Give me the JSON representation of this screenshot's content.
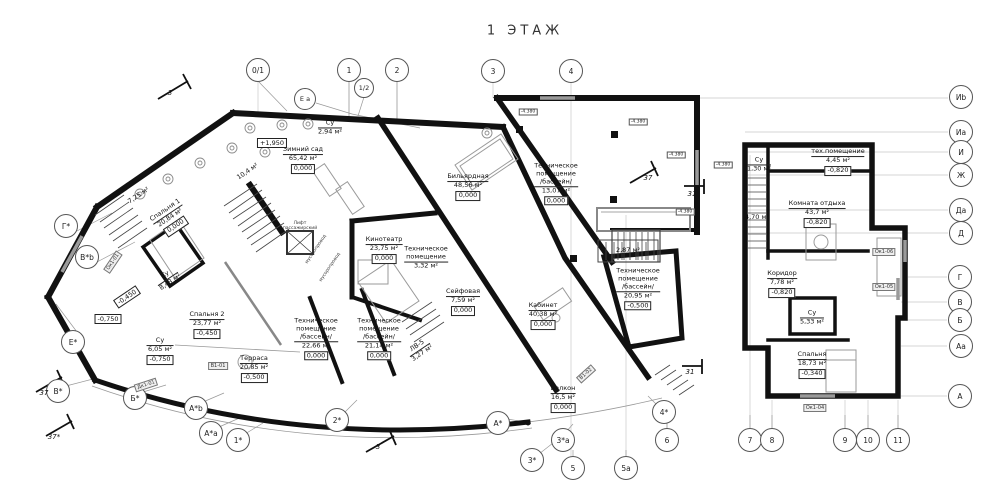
{
  "title": "1  ЭТАЖ",
  "rooms": [
    {
      "name": "Зимний сад",
      "area": "65,42 м²",
      "level": "0,000",
      "x": 303,
      "y": 160,
      "rot": 0
    },
    {
      "name": "Су",
      "area": "2,94 м²",
      "level": "",
      "x": 330,
      "y": 128,
      "rot": 0
    },
    {
      "name": "",
      "area": "10,4 м²",
      "level": "",
      "x": 248,
      "y": 172,
      "rot": -34
    },
    {
      "name": "",
      "area": "7,25 м²",
      "level": "",
      "x": 139,
      "y": 196,
      "rot": -34
    },
    {
      "name": "Спальня 1",
      "area": "20,84 м²",
      "level": "0,000",
      "x": 171,
      "y": 219,
      "rot": -34
    },
    {
      "name": "Су",
      "area": "8,43 м²",
      "level": "",
      "x": 168,
      "y": 279,
      "rot": -34
    },
    {
      "name": "Спальня 2",
      "area": "23,77 м²",
      "level": "-0,450",
      "x": 207,
      "y": 325,
      "rot": 0
    },
    {
      "name": "Су",
      "area": "6,05 м²",
      "level": "-0,750",
      "x": 160,
      "y": 351,
      "rot": 0
    },
    {
      "name": "Терраса",
      "area": "20,85 м²",
      "level": "-0,500",
      "x": 254,
      "y": 369,
      "rot": 0
    },
    {
      "name": "Техническое\nпомещение\n/бассейн/",
      "area": "22,66 м²",
      "level": "0,000",
      "x": 316,
      "y": 339,
      "rot": 0
    },
    {
      "name": "Техническое\nпомещение\n/бассейн/",
      "area": "21,14 м²",
      "level": "0,000",
      "x": 379,
      "y": 339,
      "rot": 0
    },
    {
      "name": "ЛВ-5",
      "area": "3,27 м²",
      "level": "",
      "x": 420,
      "y": 350,
      "rot": -34
    },
    {
      "name": "Кинотеатр",
      "area": "23,75 м²",
      "level": "0,000",
      "x": 384,
      "y": 250,
      "rot": 0
    },
    {
      "name": "Техническое\nпомещение",
      "area": "3,32 м²",
      "level": "",
      "x": 426,
      "y": 258,
      "rot": 0
    },
    {
      "name": "Бильярдная",
      "area": "48,56 м²",
      "level": "0,000",
      "x": 468,
      "y": 187,
      "rot": 0
    },
    {
      "name": "Сейфовая",
      "area": "7,59 м²",
      "level": "0,000",
      "x": 463,
      "y": 302,
      "rot": 0
    },
    {
      "name": "Кабинет",
      "area": "40,38 м²",
      "level": "0,000",
      "x": 543,
      "y": 316,
      "rot": 0
    },
    {
      "name": "Балкон",
      "area": "16,5 м²",
      "level": "0,000",
      "x": 563,
      "y": 399,
      "rot": 0
    },
    {
      "name": "Техническое\nпомещение\n/бассейн/",
      "area": "13,07 м²",
      "level": "0,000",
      "x": 556,
      "y": 184,
      "rot": 0
    },
    {
      "name": "",
      "area": "2,87 м²",
      "level": "",
      "x": 628,
      "y": 251,
      "rot": 0
    },
    {
      "name": "Техническое\nпомещение\n/бассейн/",
      "area": "20,95 м²",
      "level": "-0,500",
      "x": 638,
      "y": 289,
      "rot": 0
    },
    {
      "name": "тех.помещение",
      "area": "4,45 м²",
      "level": "-0,820",
      "x": 838,
      "y": 162,
      "rot": 0
    },
    {
      "name": "Комната отдыха",
      "area": "43,7 м²",
      "level": "-0,820",
      "x": 817,
      "y": 214,
      "rot": 0
    },
    {
      "name": "Коридор",
      "area": "7,78 м²",
      "level": "-0,820",
      "x": 782,
      "y": 284,
      "rot": 0
    },
    {
      "name": "Су",
      "area": "5,33 м²",
      "level": "",
      "x": 812,
      "y": 318,
      "rot": 0
    },
    {
      "name": "Спальня",
      "area": "18,73 м²",
      "level": "-0,340",
      "x": 812,
      "y": 365,
      "rot": 0
    },
    {
      "name": "Су",
      "area": "1,30 м²",
      "level": "",
      "x": 759,
      "y": 165,
      "rot": 0
    },
    {
      "name": "",
      "area": "4,70 м²",
      "level": "",
      "x": 757,
      "y": 218,
      "rot": 0
    }
  ],
  "elevations": [
    {
      "value": "+1,950",
      "x": 272,
      "y": 143,
      "rot": 0
    },
    {
      "value": "-0,450",
      "x": 127,
      "y": 297,
      "rot": -34
    },
    {
      "value": "-0,750",
      "x": 108,
      "y": 319,
      "rot": 0
    }
  ],
  "axis_bubbles": [
    {
      "label": "0/1",
      "x": 258,
      "y": 70,
      "r": 11
    },
    {
      "label": "1",
      "x": 349,
      "y": 70,
      "r": 11
    },
    {
      "label": "1/2",
      "x": 364,
      "y": 88,
      "r": 9
    },
    {
      "label": "2",
      "x": 397,
      "y": 70,
      "r": 11
    },
    {
      "label": "Е а",
      "x": 305,
      "y": 99,
      "r": 10
    },
    {
      "label": "3",
      "x": 493,
      "y": 71,
      "r": 11
    },
    {
      "label": "4",
      "x": 571,
      "y": 71,
      "r": 11
    },
    {
      "label": "Иb",
      "x": 961,
      "y": 97,
      "r": 11
    },
    {
      "label": "Иа",
      "x": 961,
      "y": 132,
      "r": 11
    },
    {
      "label": "И",
      "x": 961,
      "y": 152,
      "r": 11
    },
    {
      "label": "Ж",
      "x": 961,
      "y": 175,
      "r": 11
    },
    {
      "label": "Да",
      "x": 961,
      "y": 210,
      "r": 11
    },
    {
      "label": "Д",
      "x": 961,
      "y": 233,
      "r": 11
    },
    {
      "label": "Г",
      "x": 960,
      "y": 277,
      "r": 11
    },
    {
      "label": "В",
      "x": 960,
      "y": 302,
      "r": 11
    },
    {
      "label": "Б",
      "x": 960,
      "y": 320,
      "r": 11
    },
    {
      "label": "Аа",
      "x": 961,
      "y": 346,
      "r": 11
    },
    {
      "label": "А",
      "x": 960,
      "y": 396,
      "r": 11
    },
    {
      "label": "Г*",
      "x": 66,
      "y": 226,
      "r": 11
    },
    {
      "label": "В*b",
      "x": 87,
      "y": 257,
      "r": 11
    },
    {
      "label": "Е*",
      "x": 73,
      "y": 342,
      "r": 11
    },
    {
      "label": "В*",
      "x": 58,
      "y": 391,
      "r": 11
    },
    {
      "label": "Б*",
      "x": 135,
      "y": 398,
      "r": 11
    },
    {
      "label": "А*b",
      "x": 196,
      "y": 408,
      "r": 11
    },
    {
      "label": "А*а",
      "x": 211,
      "y": 433,
      "r": 11
    },
    {
      "label": "1*",
      "x": 238,
      "y": 440,
      "r": 11
    },
    {
      "label": "2*",
      "x": 337,
      "y": 420,
      "r": 11
    },
    {
      "label": "А*",
      "x": 498,
      "y": 423,
      "r": 11
    },
    {
      "label": "3*",
      "x": 532,
      "y": 460,
      "r": 11
    },
    {
      "label": "3*а",
      "x": 563,
      "y": 440,
      "r": 11
    },
    {
      "label": "5",
      "x": 573,
      "y": 468,
      "r": 11
    },
    {
      "label": "5а",
      "x": 626,
      "y": 468,
      "r": 11
    },
    {
      "label": "4*",
      "x": 664,
      "y": 412,
      "r": 11
    },
    {
      "label": "6",
      "x": 667,
      "y": 440,
      "r": 11
    },
    {
      "label": "7",
      "x": 750,
      "y": 440,
      "r": 11
    },
    {
      "label": "8",
      "x": 772,
      "y": 440,
      "r": 11
    },
    {
      "label": "9",
      "x": 845,
      "y": 440,
      "r": 11
    },
    {
      "label": "10",
      "x": 868,
      "y": 440,
      "r": 11
    },
    {
      "label": "11",
      "x": 898,
      "y": 440,
      "r": 11
    }
  ],
  "section_markers": [
    {
      "label": "3",
      "x": 170,
      "y": 93
    },
    {
      "label": "3",
      "x": 378,
      "y": 447
    },
    {
      "label": "37",
      "x": 44,
      "y": 393
    },
    {
      "label": "37*",
      "x": 54,
      "y": 437
    },
    {
      "label": "37",
      "x": 648,
      "y": 178
    },
    {
      "label": "31",
      "x": 692,
      "y": 194
    },
    {
      "label": "31",
      "x": 690,
      "y": 372
    }
  ],
  "tags": [
    {
      "value": "Ок1-01",
      "x": 113,
      "y": 262,
      "rot": -56
    },
    {
      "value": "Дк1-01",
      "x": 146,
      "y": 385,
      "rot": -18
    },
    {
      "value": "В1-01",
      "x": 218,
      "y": 366,
      "rot": 0
    },
    {
      "value": "В1-02",
      "x": 586,
      "y": 374,
      "rot": -42
    },
    {
      "value": "Ок1-06",
      "x": 884,
      "y": 252,
      "rot": 0
    },
    {
      "value": "Ок1-05",
      "x": 884,
      "y": 287,
      "rot": 0
    },
    {
      "value": "Ок1-04",
      "x": 815,
      "y": 408,
      "rot": 0
    }
  ],
  "small_tags": [
    {
      "value": "-4.380",
      "x": 528,
      "y": 112
    },
    {
      "value": "-4.380",
      "x": 638,
      "y": 122
    },
    {
      "value": "-4.380",
      "x": 676,
      "y": 155
    },
    {
      "value": "-4.380",
      "x": 723,
      "y": 165
    },
    {
      "value": "-4.380",
      "x": 685,
      "y": 212
    }
  ],
  "small_texts": [
    {
      "value": "Лифт\nпассажирский",
      "x": 300,
      "y": 227,
      "rot": 0
    },
    {
      "value": "мусоропровод",
      "x": 317,
      "y": 250,
      "rot": -56
    },
    {
      "value": "мусоропровод",
      "x": 331,
      "y": 268,
      "rot": -56
    }
  ]
}
